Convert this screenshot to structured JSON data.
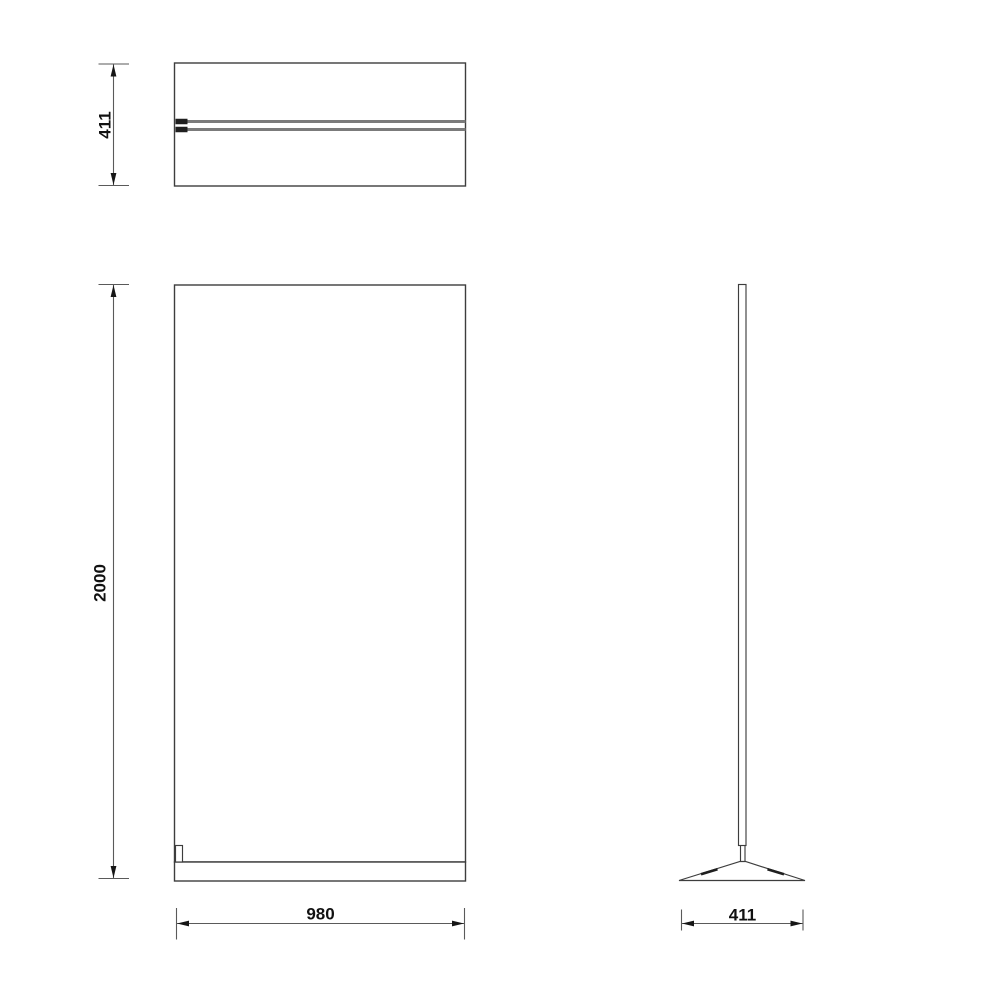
{
  "drawing": {
    "dimensions": {
      "depth_top": {
        "value": "411"
      },
      "height": {
        "value": "2000"
      },
      "width": {
        "value": "980"
      },
      "depth_base": {
        "value": "411"
      }
    },
    "colors": {
      "background": "#ffffff",
      "outline": "#3d3d3d",
      "dim_line": "#5a5a5a",
      "arrow": "#161616",
      "section_line": "#7b7b7b",
      "section_cap": "#1f1f1f",
      "text": "#111111"
    }
  }
}
